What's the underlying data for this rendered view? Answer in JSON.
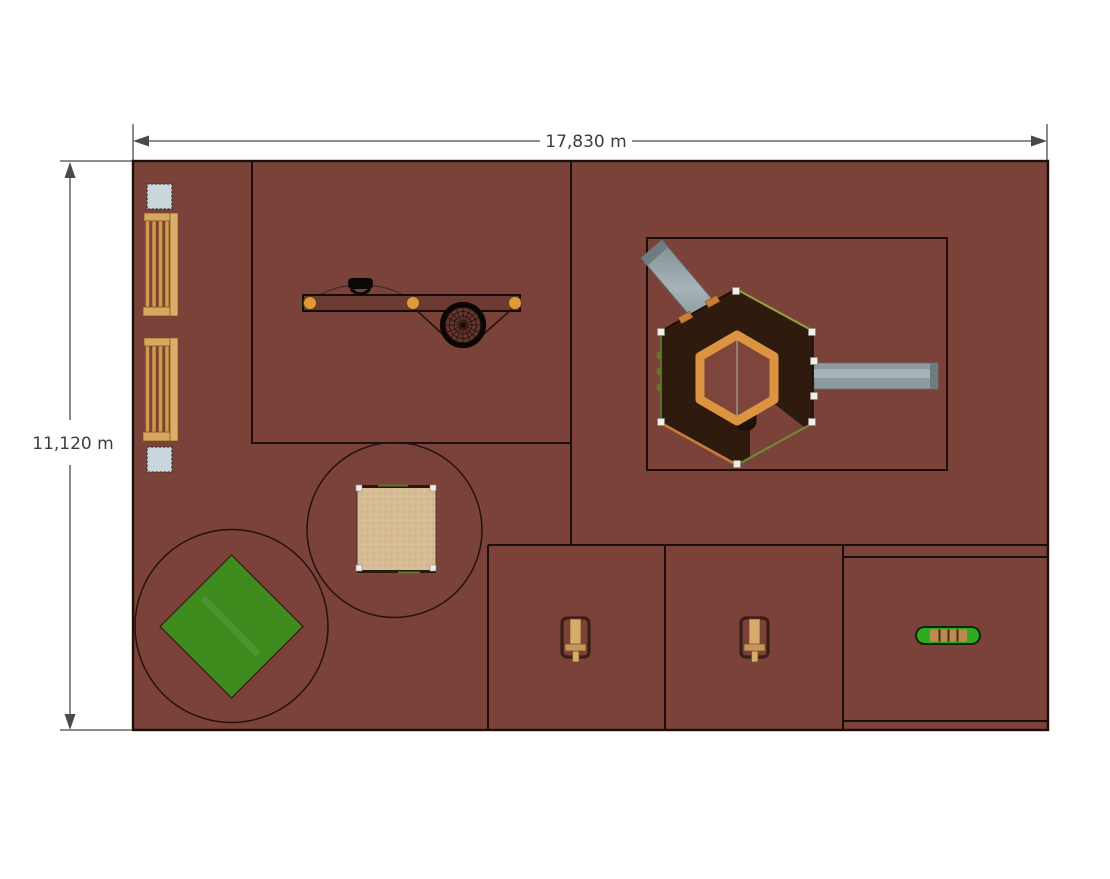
{
  "plan": {
    "type": "playground-top-view-plan",
    "dimensions": {
      "width_label": "17,830 m",
      "height_label": "11,120 m"
    },
    "equipment_counts": {
      "benches": 2,
      "square_tables": 2,
      "swing_beam_with_spinner": 1,
      "hex_climbing_tower": 1,
      "slides": 2,
      "sandbox": 1,
      "green_mat": 1,
      "spring_riders": 2,
      "balance_beam": 1
    }
  },
  "colors": {
    "ground": "#7b423a",
    "outline": "#1b0e0b",
    "platform": "#2e1b0e",
    "ring_orange": "#dd9440",
    "slide_gray": "#8d9aa0",
    "sand": "#d6bb95",
    "mat_green": "#3e8b1d",
    "beam_green": "#2eab1f",
    "wood": "#d7a75f",
    "post_white": "#efeee8",
    "table_blue": "#c9d7dd",
    "post_orange": "#e09a3e",
    "dimension_line": "#4a4a4a"
  }
}
